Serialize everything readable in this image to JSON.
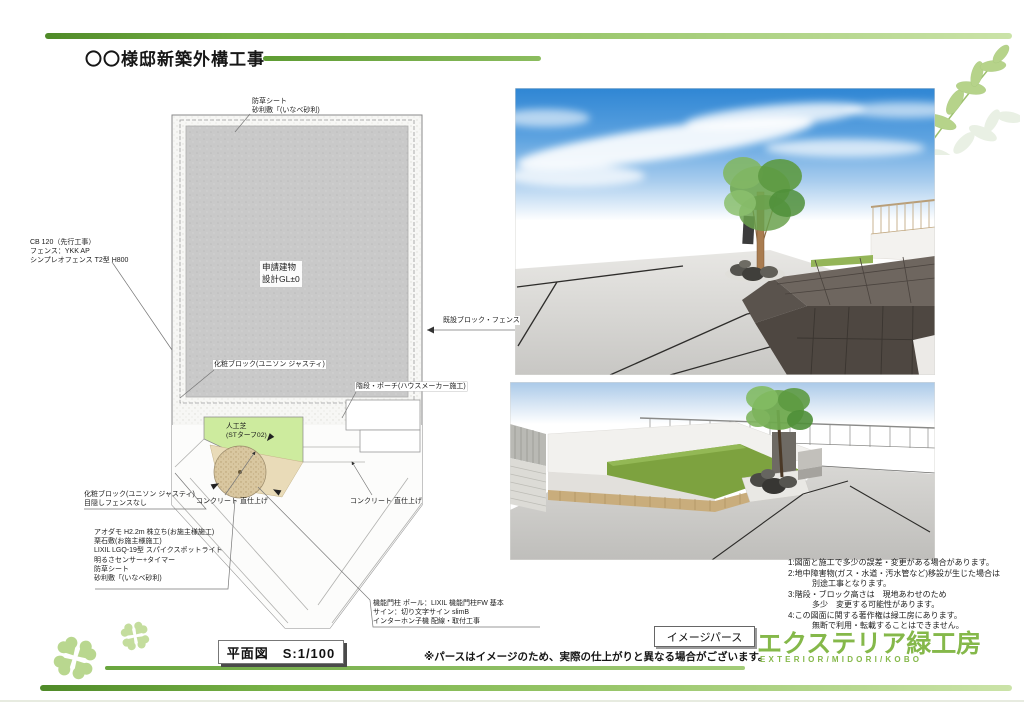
{
  "title": "〇〇様邸新築外構工事",
  "colors": {
    "accent_green": "#79b348",
    "logo_green": "#85b84a",
    "turf_green": "#cdeb9e",
    "sky_blue": "#3d8ed6",
    "plan_gray": "#c9c9c9"
  },
  "plan": {
    "labels": {
      "weed_sheet_top": "防草シート\n砂利敷「(いなべ砂利)",
      "cb_fence": "CB 120（先行工事）\nフェンス：YKK AP\nシンプレオフェンス T2型 H800",
      "deco_block_inner": "化粧ブロック(ユニソン ジャスティ)",
      "existing_fence": "既設ブロック・フェンス",
      "stairs_porch": "階段・ポーチ(ハウスメーカー施工)",
      "building": "申請建物\n設計GL±0",
      "turf": "人工芝\n(STターフ02)",
      "deco_block_left": "化粧ブロック(ユニソン ジャスティ)\n目隠しフェンスなし",
      "concrete_left": "コンクリート 直仕上げ",
      "concrete_right": "コンクリート 直仕上げ",
      "tree_spec": "アオダモ H2.2m 株立ち(お施主様施工)\n栗石敷(お施主様施工)\nLIXIL LGQ-19型 スパイクスポットライト\n明るさセンサー+タイマー\n防草シート\n砂利敷「(いなべ砂利)",
      "gate_pillar": "機能門柱 ポール：LIXIL 機能門柱FW 基本\nサイン：切り文字サイン slimB\nインターホン子機 配線・取付工事"
    },
    "scale_box": "平面図　S:1/100"
  },
  "perspective": {
    "box_label": "イメージパース",
    "caption": "※パースはイメージのため、実際の仕上がりと異なる場合がございます。"
  },
  "notes": [
    "1:図面と施工で多少の誤差・変更がある場合があります。",
    "2:地中障害物(ガス・水道・汚水管など)移設が生じた場合は",
    "　　　別途工事となります。",
    "3:階段・ブロック高さは　現地あわせのため",
    "　　　多少　変更する可能性があります。",
    "4:この図面に関する著作権は緑工房にあります。",
    "　　　無断で利用・転載することはできません。"
  ],
  "logo": {
    "name": "エクステリア緑工房",
    "sub": "EXTERIOR/MIDORI/KOBO"
  }
}
